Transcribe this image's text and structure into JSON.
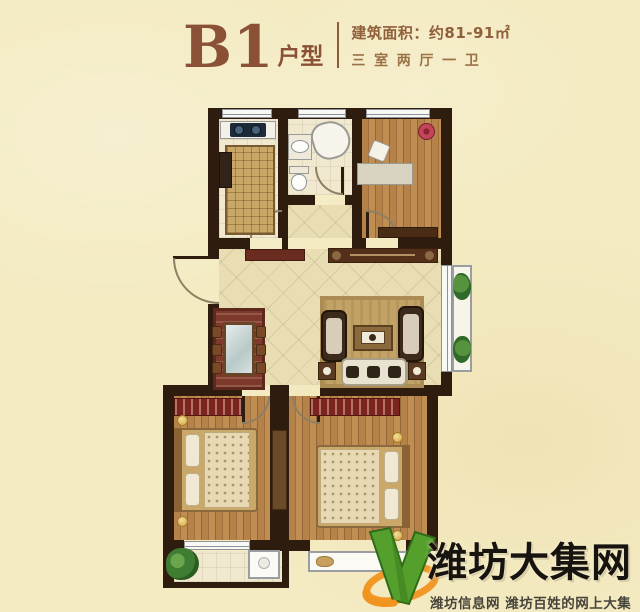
{
  "header": {
    "plan_code": "B1",
    "plan_code_suffix": "户型",
    "area_text": "建筑面积：约81-91㎡",
    "rooms_text": "三室两厅一卫"
  },
  "watermark": {
    "site_name": "潍坊大集网",
    "tagline": "潍坊信息网 潍坊百姓的网上大集",
    "logo_icon": "green-v-check-logo"
  },
  "colors": {
    "background": "#f4ebc3",
    "wall": "#2e1d0f",
    "title_brown": "#8a5136",
    "subtitle_brown": "#9b7146",
    "wood_floor": "#b3804a",
    "tile_floor": "#e9ddb4",
    "living_rug": "#c2a265",
    "dining_rug": "#7c392c",
    "wardrobe_red": "#7e241f",
    "logo_green": "#55a02c",
    "logo_orange": "#f0941f",
    "watermark_text": "#17130e"
  }
}
